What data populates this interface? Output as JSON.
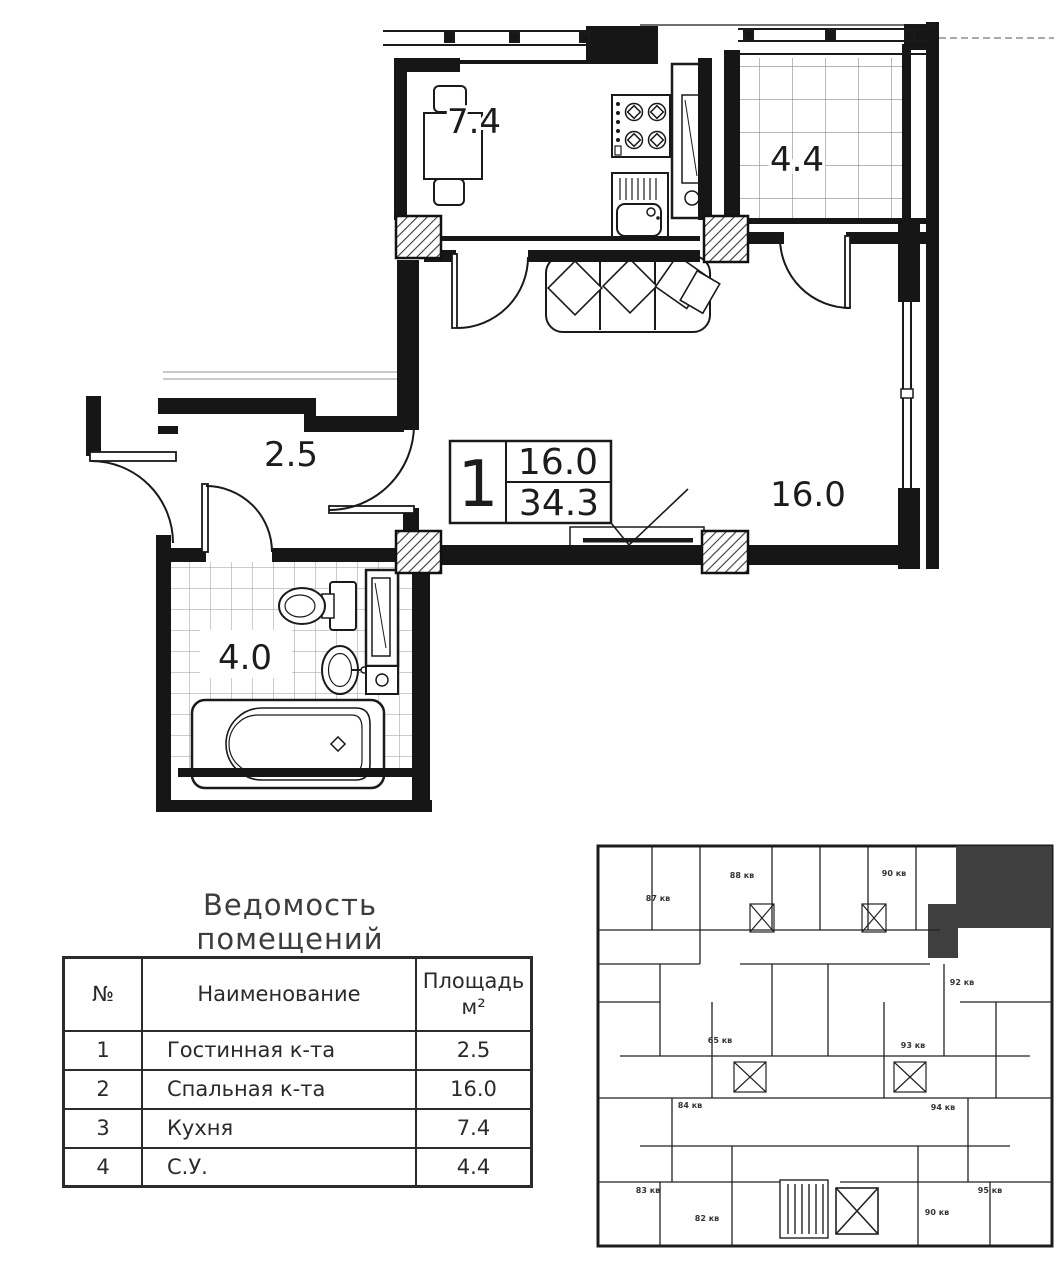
{
  "plan": {
    "room_labels": {
      "kitchen": "7.4",
      "balcony": "4.4",
      "hallway": "2.5",
      "living_room": "16.0",
      "bathroom": "4.0"
    },
    "info_box": {
      "rooms": "1",
      "living_area": "16.0",
      "total_area": "34.3"
    }
  },
  "schedule": {
    "title": "Ведомость помещений",
    "col_num": "№",
    "col_name": "Наименование",
    "col_area_line1": "Площадь",
    "col_area_line2": "м²",
    "rows": [
      {
        "num": "1",
        "name": "Гостинная к-та",
        "area": "2.5"
      },
      {
        "num": "2",
        "name": "Спальная к-та",
        "area": "16.0"
      },
      {
        "num": "3",
        "name": "Кухня",
        "area": "7.4"
      },
      {
        "num": "4",
        "name": "С.У.",
        "area": "4.4"
      }
    ]
  },
  "keyplan": {
    "units": [
      "87 кв",
      "88 кв",
      "90 кв",
      "92 кв",
      "65 кв",
      "93 кв",
      "84 кв",
      "94 кв",
      "83 кв",
      "95 кв",
      "82 кв",
      "90 кв"
    ]
  }
}
